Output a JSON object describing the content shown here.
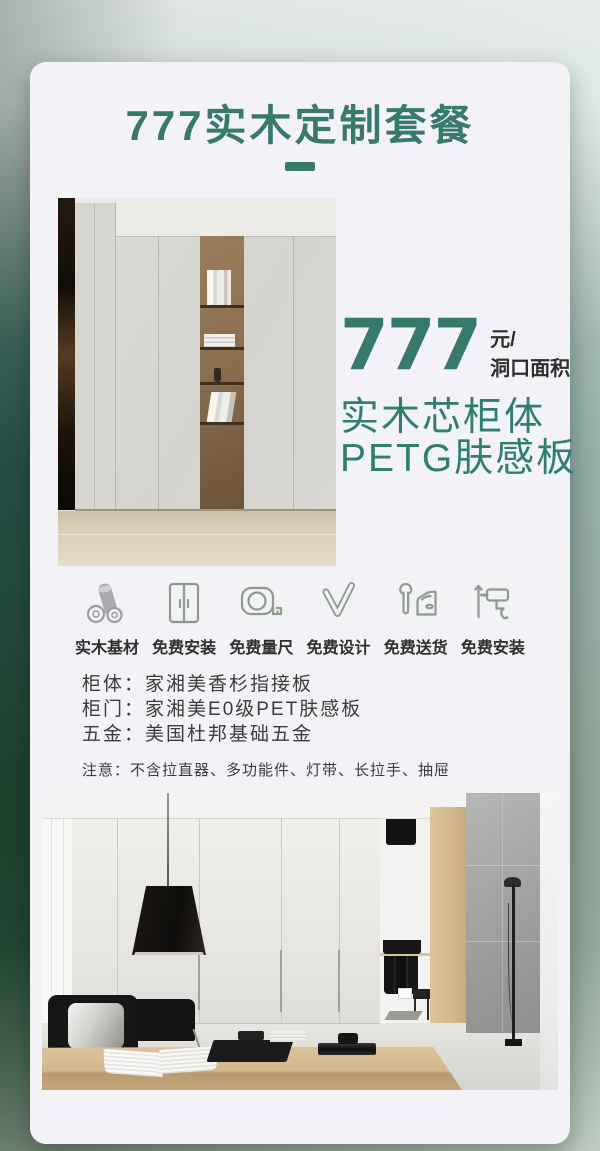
{
  "header": {
    "title": "777实木定制套餐"
  },
  "price": {
    "amount": "777",
    "unit_line1": "元/",
    "unit_line2": "洞口面积",
    "feature_line1": "实木芯柜体",
    "feature_line2": "PETG肤感板"
  },
  "services": [
    {
      "icon": "wood-logs-icon",
      "label": "实木基材"
    },
    {
      "icon": "wardrobe-icon",
      "label": "免费安装"
    },
    {
      "icon": "tape-measure-icon",
      "label": "免费量尺"
    },
    {
      "icon": "design-pencil-icon",
      "label": "免费设计"
    },
    {
      "icon": "delivery-car-icon",
      "label": "免费送货"
    },
    {
      "icon": "drill-icon",
      "label": "免费安装"
    }
  ],
  "specs": [
    {
      "label": "柜体：",
      "value": "家湘美香杉指接板"
    },
    {
      "label": "柜门：",
      "value": "家湘美E0级PET肤感板"
    },
    {
      "label": "五金：",
      "value": "美国杜邦基础五金"
    }
  ],
  "note": "注意：不含拉直器、多功能件、灯带、长拉手、抽屉",
  "colors": {
    "accent_teal": "#38796d",
    "feature_teal": "#2f7f71",
    "icon_sage": "#8c9c8d",
    "icon_gray": "#a2a2a8",
    "text_dark": "#2e2e2e",
    "card_background": "#f3f2f6"
  }
}
